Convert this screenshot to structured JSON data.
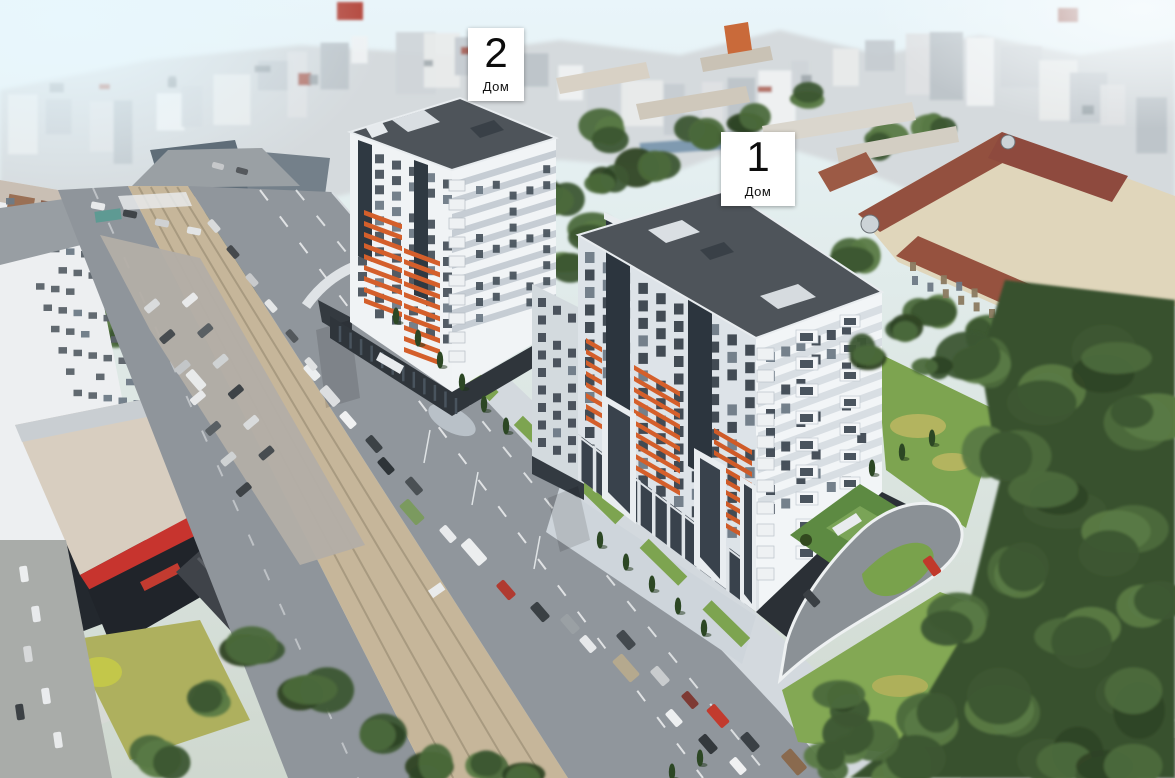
{
  "markers": {
    "two": {
      "number": "2",
      "caption": "Дом"
    },
    "one": {
      "number": "1",
      "caption": "Дом"
    }
  },
  "palette": {
    "sky": "#dcedf5",
    "city": "#d5dadd",
    "tree": "#3d5731",
    "tree_dark": "#2e4325",
    "road": "#8f959b",
    "tram_dust": "#c6b69a",
    "sidewalk": "#d3d9de",
    "render_white": "#f0f3f5",
    "facade_shadow": "#dde3e8",
    "facade_gray": "#c6cdd4",
    "glass": "#39424c",
    "accent_orange": "#d45f2b",
    "podium": "#2f353b",
    "roof": "#4e545a",
    "lawn": "#7da450",
    "lawn_dry": "#aeb05e",
    "red_building": "#c7342e",
    "beige": "#e0d6bb",
    "roof_maroon": "#8e4a3e",
    "car_red": "#c0392b",
    "marker_bg": "#ffffff",
    "marker_text": "#111111"
  }
}
